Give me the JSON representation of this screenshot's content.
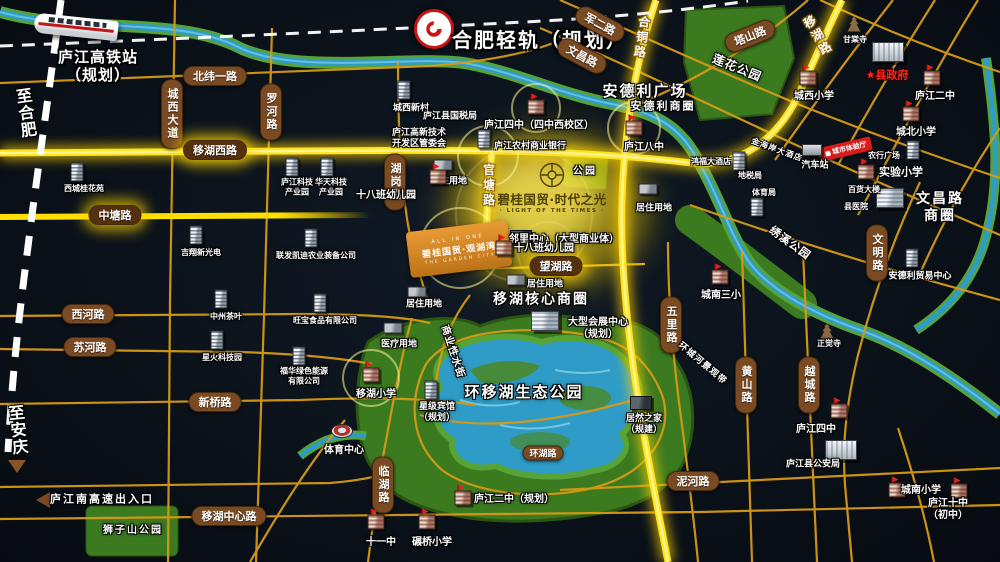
{
  "colors": {
    "glow_road": "#ffe000",
    "minor_road": "#d69a15",
    "pill_brown": "#7a4a22",
    "river": "#2e9cc6",
    "park": "#3c7a20",
    "background": "#0b121a",
    "highlight_red": "#e02020"
  },
  "metro": {
    "label": "合肥轻轨（规划）"
  },
  "hsr": {
    "label": "庐江高铁站\n（规划）"
  },
  "project": {
    "name": "碧桂国贸·时代之光",
    "subtitle": "· LIGHT OF THE TIMES ·"
  },
  "sister": {
    "tagline": "ALL IN ONE",
    "name": "碧桂国贸·观湖湾",
    "subtitle": "THE GARDEN CITY"
  },
  "banner": {
    "label": "城市体验厅"
  },
  "road_pills": [
    {
      "t": "北纬一路",
      "x": 215,
      "y": 76
    },
    {
      "t": "城西大道",
      "x": 172,
      "y": 114,
      "v": 1
    },
    {
      "t": "罗河路",
      "x": 271,
      "y": 112,
      "v": 1
    },
    {
      "t": "移湖西路",
      "x": 215,
      "y": 150,
      "dark": 1
    },
    {
      "t": "中塘路",
      "x": 115,
      "y": 215,
      "dark": 1
    },
    {
      "t": "湖岗路",
      "x": 395,
      "y": 182,
      "v": 1
    },
    {
      "t": "西河路",
      "x": 88,
      "y": 314
    },
    {
      "t": "苏河路",
      "x": 90,
      "y": 347
    },
    {
      "t": "新桥路",
      "x": 215,
      "y": 402
    },
    {
      "t": "移湖中心路",
      "x": 229,
      "y": 516
    },
    {
      "t": "望湖路",
      "x": 556,
      "y": 266,
      "dark": 1
    },
    {
      "t": "泥河路",
      "x": 693,
      "y": 481
    },
    {
      "t": "环湖路",
      "x": 543,
      "y": 453,
      "small": 1
    },
    {
      "t": "临湖路",
      "x": 383,
      "y": 485,
      "v": 1
    },
    {
      "t": "五里路",
      "x": 671,
      "y": 325,
      "v": 1
    },
    {
      "t": "黄山路",
      "x": 746,
      "y": 385,
      "v": 1
    },
    {
      "t": "越城路",
      "x": 809,
      "y": 385,
      "v": 1
    },
    {
      "t": "文明路",
      "x": 877,
      "y": 253,
      "v": 1
    },
    {
      "t": "军二路",
      "x": 600,
      "y": 24,
      "r": 28
    },
    {
      "t": "文昌路",
      "x": 582,
      "y": 56,
      "r": 28
    },
    {
      "t": "塔山路",
      "x": 750,
      "y": 36,
      "r": -22
    }
  ],
  "glow_labels": [
    {
      "t": "官塘路",
      "x": 489,
      "y": 186,
      "r": 0
    },
    {
      "t": "合铜路",
      "x": 642,
      "y": 38,
      "r": 8
    },
    {
      "t": "移湖路",
      "x": 818,
      "y": 36,
      "r": -30
    }
  ],
  "rotated_labels": [
    {
      "t": "商业性水街",
      "x": 452,
      "y": 352,
      "r": 72,
      "fs": 10
    },
    {
      "t": "环城河景观带",
      "x": 702,
      "y": 364,
      "r": 40,
      "fs": 9
    },
    {
      "t": "绣溪公园",
      "x": 790,
      "y": 243,
      "r": 36,
      "fs": 11
    },
    {
      "t": "莲花公园",
      "x": 737,
      "y": 68,
      "r": 22,
      "fs": 12
    },
    {
      "t": "金海岸大酒店",
      "x": 777,
      "y": 150,
      "r": 20,
      "fs": 8
    },
    {
      "t": "至合肥",
      "x": 25,
      "y": 113,
      "r": -8,
      "fs": 16,
      "v": 1
    },
    {
      "t": "至安庆",
      "x": 17,
      "y": 430,
      "r": -6,
      "fs": 16,
      "v": 1
    }
  ],
  "area_labels": [
    {
      "t": "安德利广场",
      "x": 645,
      "y": 91,
      "fs": 15
    },
    {
      "t": "安德利商圈",
      "x": 663,
      "y": 106,
      "fs": 11
    },
    {
      "t": "文昌路商圈",
      "x": 940,
      "y": 208,
      "fs": 14
    },
    {
      "t": "移湖核心商圈",
      "x": 541,
      "y": 300,
      "fs": 14
    },
    {
      "t": "环移湖生态公园",
      "x": 524,
      "y": 392,
      "fs": 15
    },
    {
      "t": "狮子山公园",
      "x": 133,
      "y": 531,
      "fs": 10
    },
    {
      "t": "公园",
      "x": 585,
      "y": 172,
      "fs": 10
    },
    {
      "t": "庐江南高速出入口",
      "x": 102,
      "y": 499,
      "fs": 11
    }
  ],
  "pois": [
    {
      "t": "西城桂花苑",
      "x": 84,
      "y": 189,
      "icon": "tower",
      "s": 8,
      "ix": 77,
      "iy": 172
    },
    {
      "t": "庐江科技\n产业园",
      "x": 297,
      "y": 187,
      "icon": "tower",
      "s": 8,
      "ix": 292,
      "iy": 167
    },
    {
      "t": "华天科技\n产业园",
      "x": 331,
      "y": 187,
      "icon": "tower",
      "s": 8,
      "ix": 327,
      "iy": 167
    },
    {
      "t": "城西新村",
      "x": 411,
      "y": 109,
      "icon": "tower",
      "s": 9,
      "ix": 404,
      "iy": 90
    },
    {
      "t": "庐江县国税局",
      "x": 450,
      "y": 117,
      "s": 9
    },
    {
      "t": "庐江高新技术\n开发区管委会",
      "x": 419,
      "y": 139,
      "s": 9
    },
    {
      "t": "庐江四中（四中西校区）",
      "x": 539,
      "y": 126,
      "icon": "school",
      "s": 10,
      "ix": 536,
      "iy": 107
    },
    {
      "t": "庐江农村商业银行",
      "x": 530,
      "y": 147,
      "icon": "tower",
      "s": 9,
      "ix": 484,
      "iy": 139
    },
    {
      "t": "吉翔新光电",
      "x": 201,
      "y": 253,
      "icon": "tower",
      "s": 8,
      "ix": 196,
      "iy": 235
    },
    {
      "t": "联发凯迪农业装备公司",
      "x": 316,
      "y": 256,
      "icon": "tower",
      "s": 8,
      "ix": 311,
      "iy": 238
    },
    {
      "t": "中州茶叶",
      "x": 226,
      "y": 317,
      "icon": "tower",
      "s": 8,
      "ix": 221,
      "iy": 299
    },
    {
      "t": "旺宝食品有限公司",
      "x": 325,
      "y": 321,
      "icon": "tower",
      "s": 8,
      "ix": 320,
      "iy": 303
    },
    {
      "t": "星火科技园",
      "x": 222,
      "y": 358,
      "icon": "tower",
      "s": 8,
      "ix": 217,
      "iy": 340
    },
    {
      "t": "福华绿色能源\n有限公司",
      "x": 304,
      "y": 376,
      "icon": "tower",
      "s": 8,
      "ix": 299,
      "iy": 356
    },
    {
      "t": "居住用地",
      "x": 449,
      "y": 182,
      "icon": "flat",
      "s": 9,
      "ix": 443,
      "iy": 165
    },
    {
      "t": "居住用地",
      "x": 654,
      "y": 209,
      "icon": "flat",
      "s": 9,
      "ix": 648,
      "iy": 189
    },
    {
      "t": "居住用地",
      "x": 545,
      "y": 285,
      "icon": "flat",
      "s": 9,
      "ix": 516,
      "iy": 280
    },
    {
      "t": "居住用地",
      "x": 424,
      "y": 305,
      "icon": "flat",
      "s": 9,
      "ix": 417,
      "iy": 292
    },
    {
      "t": "十八班幼儿园",
      "x": 386,
      "y": 196,
      "icon": "school",
      "s": 10,
      "ix": 438,
      "iy": 177
    },
    {
      "t": "邻里中心（大型商业体）",
      "x": 564,
      "y": 240,
      "icon": "dark",
      "s": 10,
      "ix": 521,
      "iy": 237
    },
    {
      "t": "十八班幼儿园",
      "x": 544,
      "y": 249,
      "icon": "school",
      "s": 10,
      "ix": 504,
      "iy": 248
    },
    {
      "t": "大型会展中心\n（规划）",
      "x": 598,
      "y": 329,
      "icon": "complex",
      "s": 10,
      "ix": 545,
      "iy": 321
    },
    {
      "t": "医疗用地",
      "x": 399,
      "y": 345,
      "icon": "flat",
      "s": 9,
      "ix": 393,
      "iy": 328
    },
    {
      "t": "移湖小学",
      "x": 376,
      "y": 395,
      "icon": "school",
      "s": 10,
      "ix": 371,
      "iy": 375
    },
    {
      "t": "星级宾馆\n（规划）",
      "x": 437,
      "y": 413,
      "icon": "tower",
      "s": 9,
      "ix": 431,
      "iy": 390
    },
    {
      "t": "体育中心",
      "x": 344,
      "y": 451,
      "icon": "stadium",
      "s": 10,
      "ix": 342,
      "iy": 431
    },
    {
      "t": "庐江二中（规划）",
      "x": 514,
      "y": 500,
      "icon": "school",
      "s": 10,
      "ix": 463,
      "iy": 498
    },
    {
      "t": "十一中",
      "x": 381,
      "y": 543,
      "icon": "school",
      "s": 10,
      "ix": 376,
      "iy": 522
    },
    {
      "t": "碾桥小学",
      "x": 432,
      "y": 543,
      "icon": "school",
      "s": 10,
      "ix": 427,
      "iy": 522
    },
    {
      "t": "甘棠寺",
      "x": 855,
      "y": 40,
      "icon": "pagoda",
      "s": 8,
      "ix": 854,
      "iy": 24
    },
    {
      "t": "★县政府",
      "x": 887,
      "y": 75,
      "icon": "gov",
      "s": 11,
      "red": 1,
      "ix": 888,
      "iy": 52
    },
    {
      "t": "城西小学",
      "x": 814,
      "y": 97,
      "icon": "school",
      "s": 10,
      "ix": 808,
      "iy": 78
    },
    {
      "t": "庐江二中",
      "x": 935,
      "y": 97,
      "icon": "school",
      "s": 10,
      "ix": 932,
      "iy": 78
    },
    {
      "t": "城北小学",
      "x": 916,
      "y": 133,
      "icon": "school",
      "s": 10,
      "ix": 911,
      "iy": 114
    },
    {
      "t": "庐江八中",
      "x": 644,
      "y": 148,
      "icon": "school",
      "s": 10,
      "ix": 634,
      "iy": 128
    },
    {
      "t": "鸿福大酒店",
      "x": 711,
      "y": 162,
      "s": 8
    },
    {
      "t": "汽车站",
      "x": 815,
      "y": 166,
      "icon": "station",
      "s": 9,
      "ix": 812,
      "iy": 150
    },
    {
      "t": "地税局",
      "x": 750,
      "y": 176,
      "icon": "tower",
      "s": 8,
      "ix": 739,
      "iy": 161
    },
    {
      "t": "体育局",
      "x": 764,
      "y": 193,
      "icon": "tower",
      "s": 8,
      "ix": 757,
      "iy": 207
    },
    {
      "t": "农行广场",
      "x": 884,
      "y": 156,
      "icon": "tower",
      "s": 8,
      "ix": 913,
      "iy": 150
    },
    {
      "t": "实验小学",
      "x": 901,
      "y": 172,
      "icon": "school",
      "s": 11,
      "ix": 866,
      "iy": 172
    },
    {
      "t": "百货大楼",
      "x": 864,
      "y": 190,
      "icon": "complex",
      "s": 8,
      "ix": 890,
      "iy": 198
    },
    {
      "t": "县医院",
      "x": 856,
      "y": 207,
      "s": 8
    },
    {
      "t": "安德利贸易中心",
      "x": 920,
      "y": 277,
      "icon": "tower",
      "s": 9,
      "ix": 912,
      "iy": 258
    },
    {
      "t": "城南三小",
      "x": 721,
      "y": 296,
      "icon": "school",
      "s": 10,
      "ix": 720,
      "iy": 277
    },
    {
      "t": "正觉寺",
      "x": 829,
      "y": 344,
      "icon": "pagoda",
      "s": 8,
      "ix": 827,
      "iy": 331
    },
    {
      "t": "居然之家\n（规建）",
      "x": 644,
      "y": 425,
      "icon": "dark",
      "s": 9,
      "ix": 641,
      "iy": 403
    },
    {
      "t": "庐江四中",
      "x": 816,
      "y": 430,
      "icon": "school",
      "s": 10,
      "ix": 839,
      "iy": 411
    },
    {
      "t": "庐江县公安局",
      "x": 813,
      "y": 465,
      "icon": "gov",
      "s": 9,
      "ix": 841,
      "iy": 450
    },
    {
      "t": "城南小学",
      "x": 921,
      "y": 491,
      "icon": "school",
      "s": 10,
      "ix": 897,
      "iy": 490
    },
    {
      "t": "庐江十中（初中）",
      "x": 948,
      "y": 510,
      "icon": "school",
      "s": 10,
      "ix": 959,
      "iy": 491
    }
  ]
}
